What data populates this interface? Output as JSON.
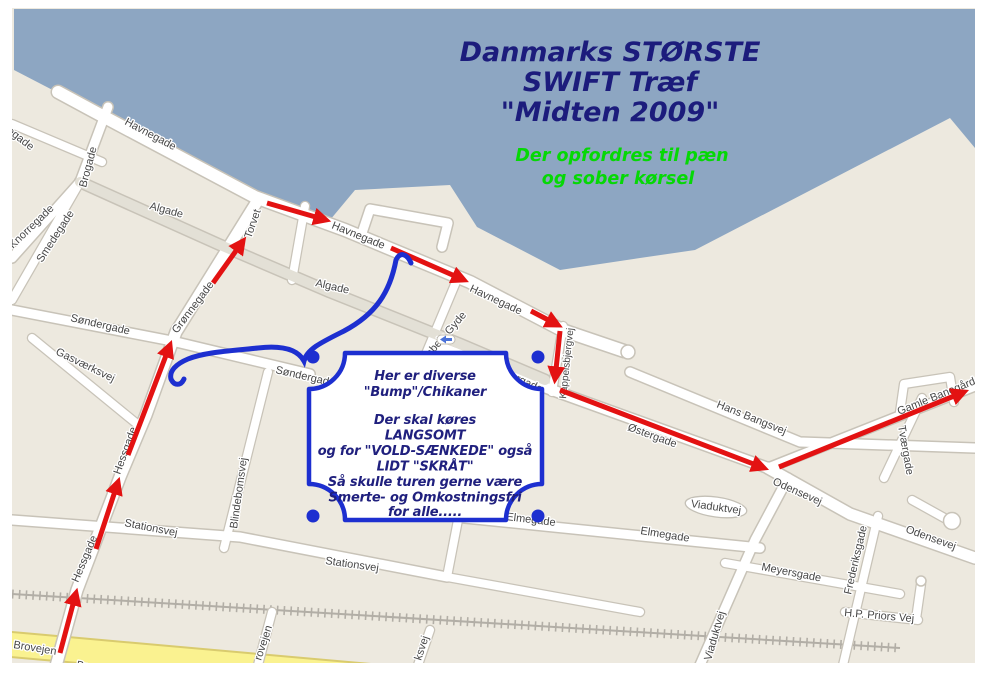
{
  "header": {
    "title_line1": "Danmarks STØRSTE",
    "title_line2": "SWIFT Træf",
    "title_line3": "\"Midten 2009\"",
    "subtitle_line1": "Der opfordres til pæn",
    "subtitle_line2": "og sober kørsel"
  },
  "note_box": {
    "line1": "Her er diverse",
    "line2": "\"Bump\"/Chikaner",
    "line3": "Der skal køres",
    "line4": "LANGSOMT",
    "line5": "og for \"VOLD-SÆNKEDE\" også",
    "line6": "LIDT \"SKRÅT\"",
    "line7": "Så skulle turen gerne være",
    "line8": "Smerte- og Omkostningsfri",
    "line9": "for alle....."
  },
  "streets": {
    "tegade": "tegade",
    "havnegade_nw": "Havnegade",
    "brogade": "Brogade",
    "knorregade": "Knorregade",
    "smedegade": "Smedegade",
    "algade_w": "Algade",
    "torvet": "Torvet",
    "havnegade_c": "Havnegade",
    "algade_c": "Algade",
    "havnegade_e": "Havnegade",
    "gimbels_gyde": "Gimbels Gyde",
    "sondergade_w": "Søndergade",
    "sondergade_c": "Søndergade",
    "gronnegade": "Grønnegade",
    "gasvaerksvej": "Gasværksvej",
    "hessgade_n": "Hessgade",
    "hessgade_s": "Hessgade",
    "blindebomsvej": "Blindebomsvej",
    "ostergade_w": "Østergade",
    "kappelsbjergvej": "Kappelsbjergvej",
    "ostergade": "Østergade",
    "hans_bangsvej": "Hans Bangsvej",
    "gamle_banegardsvej": "Gamle Banegårdsvej",
    "tvaergade": "Tværgade",
    "odensevej_n": "Odensevej",
    "odensevej_s": "Odensevej",
    "viaduktvej_oval": "Viaduktvej",
    "viaduktvej_s": "Viaduktvej",
    "elmegade_w": "Elmegade",
    "elmegade_e": "Elmegade",
    "stationsvej_w": "Stationsvej",
    "stationsvej_c": "Stationsvej",
    "meyersgade": "Meyersgade",
    "frederiksgade": "Frederiksgade",
    "hp_priors_vej": "H.P. Priors Vej",
    "brovejen_w": "Brovejen",
    "brovejen_s": "Brovejen",
    "rovejen_stub": "rovejen",
    "ksvej_stub": "ksvej"
  },
  "icons": {
    "oneway_arrow": "one-way-left-arrow"
  },
  "colors": {
    "water": "#8DA6C2",
    "land": "#EDE9DF",
    "road_fill": "#FFFFFF",
    "road_casing": "#C8C3B8",
    "main_street_fill": "#E3E0D6",
    "yellow_road": "#FAF290",
    "title_navy": "#1C1C7C",
    "subtitle_green": "#05D805",
    "route_red": "#E31212",
    "note_blue": "#1D2FD0",
    "label_gray": "#474747"
  }
}
